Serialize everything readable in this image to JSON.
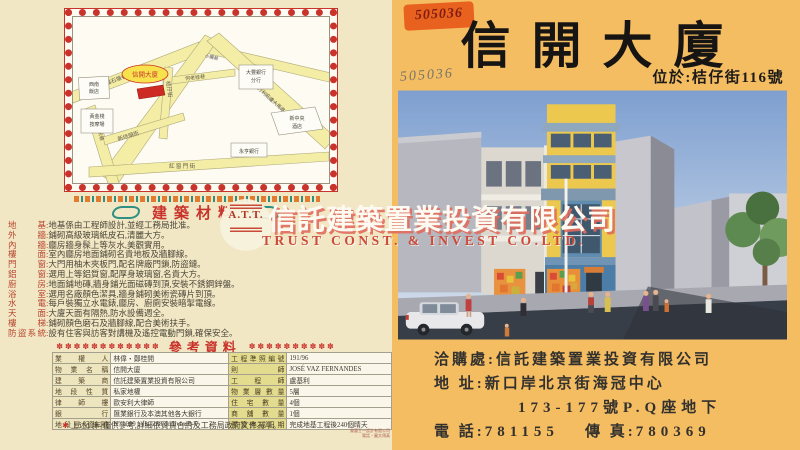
{
  "left_panel": {
    "map": {
      "site_label": "信開大廈",
      "streets": {
        "s1": "爐石塘巷",
        "s2": "新埗頭街",
        "s3": "何老桂巷",
        "s4": "桔仔街",
        "s5": "蓬萊新巷",
        "s6": "紅 窗 門 街",
        "s7": "亞美打利庇盧大馬路",
        "s8": "天通街",
        "s9": "小纜巷"
      },
      "places": {
        "p1a": "西南",
        "p1b": "飯店",
        "p2a": "黃金棧",
        "p2b": "按摩場",
        "p3a": "大豐銀行",
        "p3b": "分行",
        "p4a": "新中央",
        "p4b": "酒店",
        "p5": "永亨銀行"
      }
    },
    "materials": {
      "title": "建築材料",
      "colon": ":",
      "rows": [
        {
          "label": "地基",
          "text": "地基係由工程師設計,並經工務局批准。"
        },
        {
          "label": "外牆",
          "text": "鋪砌高級玻璃紙皮石,清麗大方。"
        },
        {
          "label": "內牆",
          "text": "廳房牆身髹上等灰水,美觀實用。"
        },
        {
          "label": "樓面",
          "text": "室內廳房地面鋪砌名貴地板及牆腳線。"
        },
        {
          "label": "門窗",
          "text": "大門用柚木夾板門,配名牌廠門鎖,防盜鏈。"
        },
        {
          "label": "鋁窗",
          "text": "選用上等鋁質窗,配厚身玻璃窗,名貴大方。"
        },
        {
          "label": "廚房",
          "text": "地面鋪地磚,牆身鋪光面磁磚到頂,安裝不銹鋼鋅盤。"
        },
        {
          "label": "浴室",
          "text": "選用名廠顏色潔具,牆身鋪砌美術瓷磚片到頂。"
        },
        {
          "label": "水電",
          "text": "每戶裝獨立水電錶,廳房、廚廁安裝暗掣電線。"
        },
        {
          "label": "天面",
          "text": "大廈天面有隔熱,防水設備週全。"
        },
        {
          "label": "樓梯",
          "text": "鋪砌顏色磨石及牆腳線,配合美術扶手。"
        },
        {
          "label": "防盜系統",
          "text": "設有住客與訪客對講機及遙控電動門鎖,確保安全。"
        }
      ]
    },
    "reference": {
      "title": "參考資料",
      "stars_left": "✽✽✽✽✽✽✽✽✽✽✽✽",
      "stars_right": "✽✽✽✽✽✽✽✽✽✽",
      "rows": [
        {
          "ll": "業權人",
          "lv": "林偉・鄭桂開",
          "rl": "工程準照編號",
          "rv": "191/96"
        },
        {
          "ll": "物業名稱",
          "lv": "信開大廈",
          "rl": "則師",
          "rv": "JOSÉ VAZ FERNANDES"
        },
        {
          "ll": "建築商",
          "lv": "信託建築置業投資有限公司",
          "rl": "工程師",
          "rv": "盧基利"
        },
        {
          "ll": "地段性質",
          "lv": "私家地權",
          "rl": "物業層數量",
          "rv": "5層"
        },
        {
          "ll": "律師樓",
          "lv": "歐安利大律師",
          "rl": "住宅數量",
          "rv": "4個"
        },
        {
          "ll": "銀行",
          "lv": "匯業銀行及本澳其他各大銀行",
          "rl": "商舖數量",
          "rv": "1個"
        },
        {
          "ll": "地段登記編號",
          "lv": "Nº 1000 a fls. 268 do livro B-6",
          "rl": "預算完成日期",
          "rv": "完成地基工程後240個晴天"
        }
      ],
      "footnote_star": "✱",
      "footnote": "上述資料僅供參考,詳細依買賣合約及工務局政府文件為準。"
    },
    "fine_print_line1": "美藝王一設計有限公司",
    "fine_print_line2": "電話・圖文傳真"
  },
  "right_panel": {
    "sticker_code": "505036",
    "pencil_code": "505036",
    "title": "信開大廈",
    "location_line": "位於:桔仔街116號",
    "contact": {
      "line1_label": "洽購處:",
      "line1_value": "信託建築置業投資有限公司",
      "line2_label": "地 址:",
      "line2_value": "新口岸北京街海冠中心",
      "line3_value": "173-177號P.Q座地下",
      "line4_label": "電 話:",
      "line4_value": "781155",
      "line4_label2": "傳 真:",
      "line4_value2": "780369"
    }
  },
  "watermark": {
    "logo_text": "A.T.T.",
    "cn": "信託建築置業投資有限公司",
    "en": "TRUST CONST. & INVEST CO.LTD."
  },
  "colors": {
    "left_bg": "#f2e7c5",
    "right_bg": "#f5bd62",
    "accent_red": "#c8342c",
    "map_street_yellow": "#f3eda6",
    "site_red": "#cc2a22",
    "teal_ornament": "#2f8f83"
  }
}
